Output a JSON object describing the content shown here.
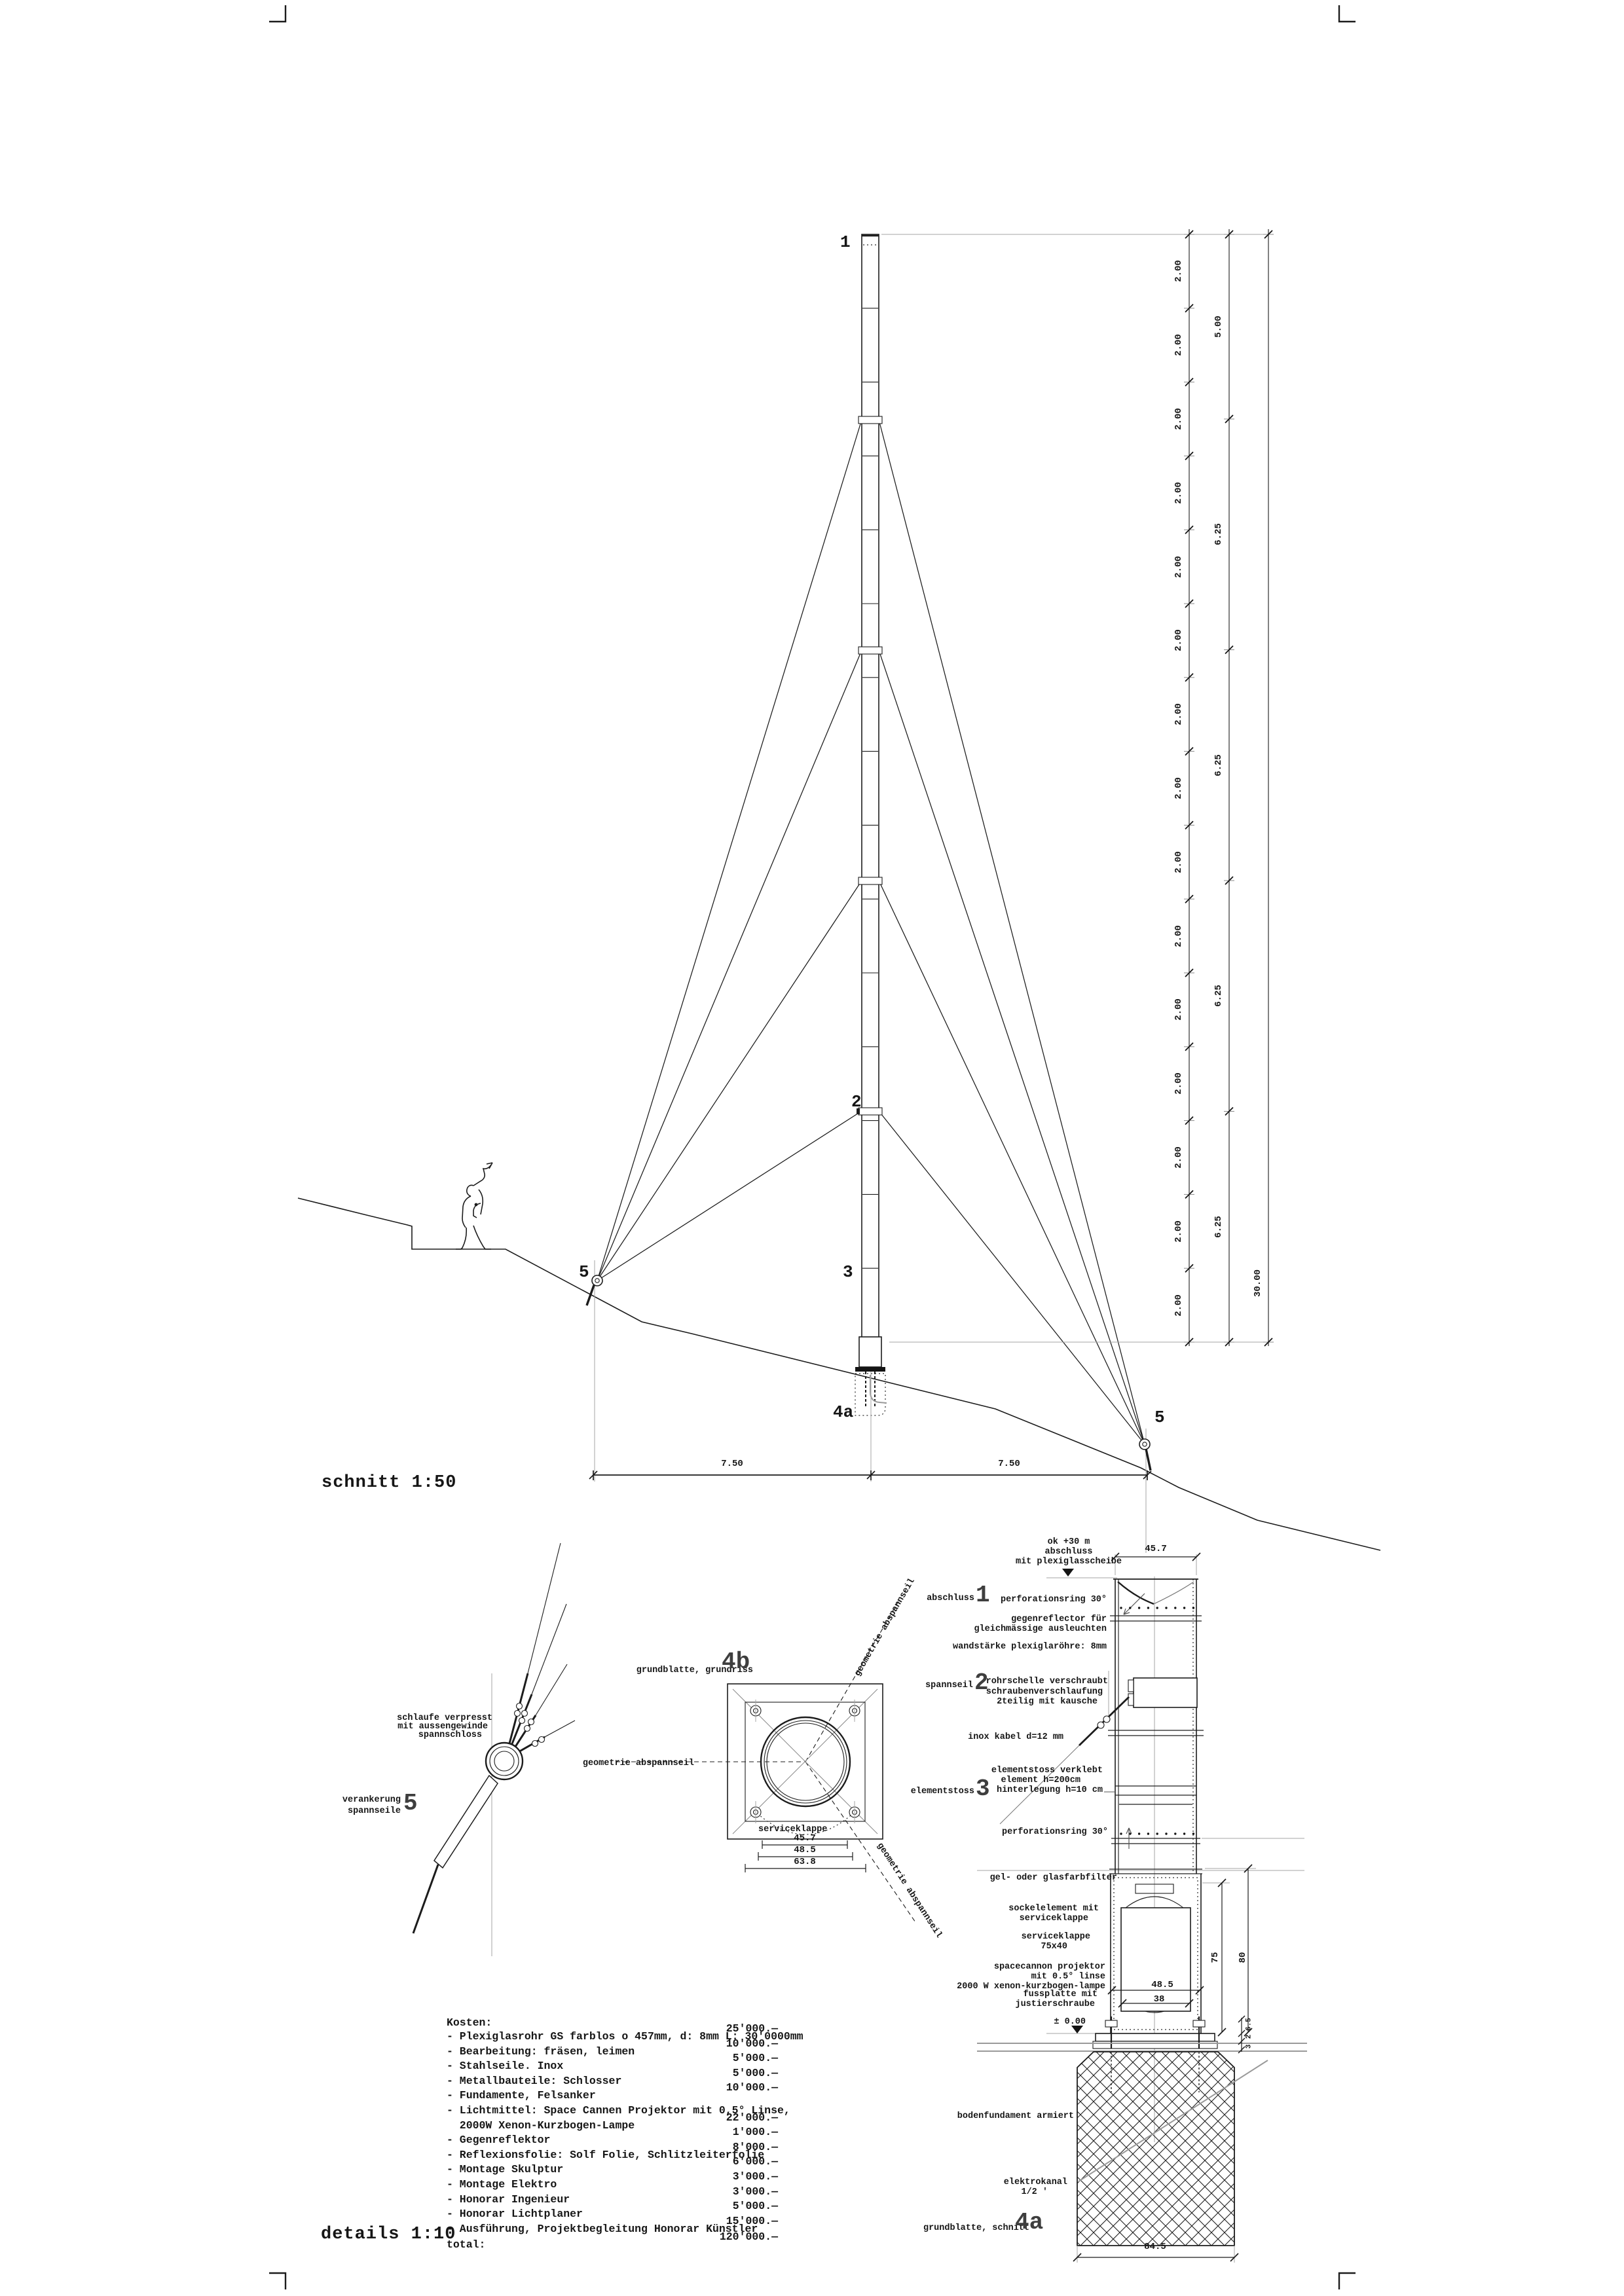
{
  "sheet": {
    "section_title": "schnitt 1:50",
    "details_title": "details 1:10"
  },
  "section": {
    "callout_1": "1",
    "callout_2": "2",
    "callout_3": "3",
    "callout_4a": "4a",
    "callout_5_left": "5",
    "callout_5_right": "5",
    "dim_col": {
      "seg_label": "2.00",
      "seg_count": 15,
      "mid_labels": [
        "5.00",
        "6.25",
        "6.25",
        "6.25",
        "6.25"
      ],
      "total_label": "30.00"
    },
    "base_dims": [
      "7.50",
      "7.50"
    ]
  },
  "anchor_detail": {
    "callout": "5",
    "title_line1": "verankerung",
    "title_line2": "spannseile",
    "note_line1": "schlaufe verpresst",
    "note_line2": "mit aussengewinde",
    "note_line3": "spannschloss"
  },
  "plate_plan": {
    "callout": "4b",
    "title": "grundblatte, grundriss",
    "axis_label": "geometrie abspannseil",
    "axis_label_upper": "geometrie abspannseil",
    "axis_label_lower": "geometrie abspannseil",
    "hatch_label": "serviceklappe",
    "dims": [
      "45.7",
      "48.5",
      "63.8"
    ]
  },
  "column_detail": {
    "callout_1": "1",
    "callout_1_label": "abschluss",
    "callout_2": "2",
    "callout_2_label": "spannseil",
    "callout_3": "3",
    "callout_3_label": "elementstoss",
    "callout_4a": "4a",
    "callout_4a_label": "grundblatte, schnitt",
    "top_note": [
      "ok +30 m",
      "abschluss",
      "mit plexiglasscheibe"
    ],
    "labels": {
      "perforation_top": "perforationsring 30°",
      "reflector1": "gegenreflector für",
      "reflector2": "gleichmässige ausleuchten",
      "wall": "wandstärke plexiglaröhre: 8mm",
      "clamp": "rohrschelle verschraubt",
      "screw1": "schraubenverschlaufung",
      "screw2": "2teilig mit kausche",
      "cable": "inox kabel d=12 mm",
      "joint1": "elementstoss verklebt",
      "joint2": "element h=200cm",
      "joint3": "hinterlegung h=10 cm",
      "perforation_bottom": "perforationsring 30°",
      "filter": "gel- oder glasfarbfilter",
      "socket1": "sockelelement mit",
      "socket2": "serviceklappe",
      "hatch1": "serviceklappe",
      "hatch2": "75x40",
      "projector1": "spacecannon projektor",
      "projector2": "mit 0.5° linse",
      "projector3": "2000 W xenon-kurzbogen-lampe",
      "foot1": "fussplatte mit",
      "foot2": "justierschraube",
      "level_zero": "± 0.00",
      "foundation": "bodenfundament armiert",
      "conduit1": "elektrokanal",
      "conduit2": "1/2 '"
    },
    "dims": {
      "top_width": "45.7",
      "inner_width": "48.5",
      "lamp_width": "38",
      "height_75": "75",
      "height_80": "80",
      "base_width": "84.5",
      "plate_dims": [
        "6.5",
        "2",
        "3"
      ]
    }
  },
  "costs": {
    "heading": "Kosten:",
    "items": [
      {
        "lines": [
          "- Plexiglasrohr GS farblos o 457mm, d: 8mm L: 30'0000mm"
        ],
        "price": "25'000.—"
      },
      {
        "lines": [
          "- Bearbeitung: fräsen, leimen"
        ],
        "price": "10'000.—"
      },
      {
        "lines": [
          "- Stahlseile. Inox"
        ],
        "price": "5'000.—"
      },
      {
        "lines": [
          "- Metallbauteile: Schlosser"
        ],
        "price": "5'000.—"
      },
      {
        "lines": [
          "- Fundamente, Felsanker"
        ],
        "price": "10'000.—"
      },
      {
        "lines": [
          "- Lichtmittel: Space Cannen Projektor mit 0,5° Linse,",
          "  2000W Xenon-Kurzbogen-Lampe"
        ],
        "price": "22'000.—"
      },
      {
        "lines": [
          "- Gegenreflektor"
        ],
        "price": "1'000.—"
      },
      {
        "lines": [
          "- Reflexionsfolie: Solf Folie, Schlitzleiterfolie"
        ],
        "price": "8'000.—"
      },
      {
        "lines": [
          "- Montage Skulptur"
        ],
        "price": "6'000.—"
      },
      {
        "lines": [
          "- Montage Elektro"
        ],
        "price": "3'000.—"
      },
      {
        "lines": [
          "- Honorar Ingenieur"
        ],
        "price": "3'000.—"
      },
      {
        "lines": [
          "- Honorar Lichtplaner"
        ],
        "price": "5'000.—"
      },
      {
        "lines": [
          "- Ausführung, Projektbegleitung Honorar Künstler"
        ],
        "price": "15'000.—"
      }
    ],
    "total_label": "total:",
    "total_price": "120'000.—"
  }
}
